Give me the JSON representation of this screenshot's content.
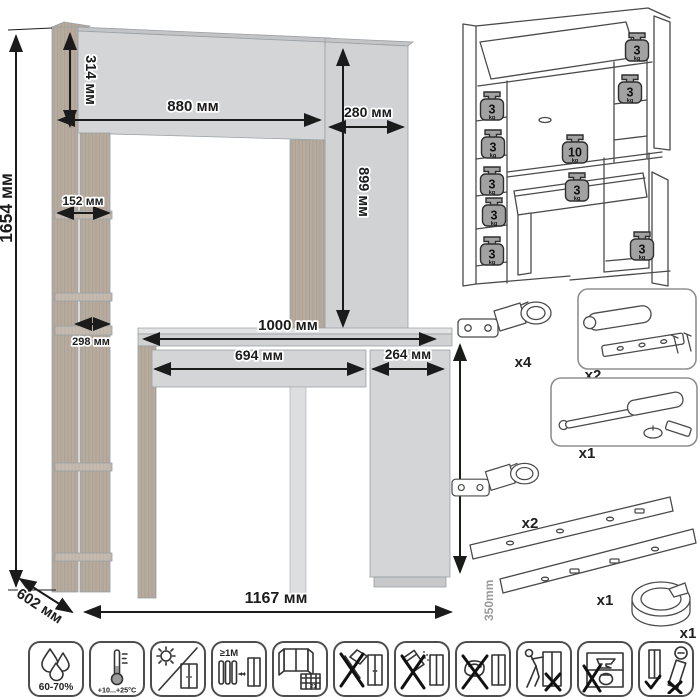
{
  "dimensions": {
    "total_height": "1654 мм",
    "hutch_height": "314 мм",
    "hutch_width": "880 мм",
    "top_right_width": "280 мм",
    "right_column_height": "899 мм",
    "upper_shelf_depth": "152 мм",
    "lower_shelf_depth": "298 мм",
    "desktop_width": "1000 мм",
    "drawer_width": "694 мм",
    "base_door_width": "264 мм",
    "desk_height": "746 мм",
    "depth": "602 мм",
    "total_width": "1167 мм"
  },
  "load_limits": {
    "weights": [
      {
        "value": "3",
        "unit": "kg",
        "location": "hutch-flap-shelf"
      },
      {
        "value": "3",
        "unit": "kg",
        "location": "right-column-shelf"
      },
      {
        "value": "3",
        "unit": "kg",
        "location": "left-shelf-1"
      },
      {
        "value": "3",
        "unit": "kg",
        "location": "left-shelf-2"
      },
      {
        "value": "3",
        "unit": "kg",
        "location": "left-shelf-3"
      },
      {
        "value": "3",
        "unit": "kg",
        "location": "left-shelf-4"
      },
      {
        "value": "3",
        "unit": "kg",
        "location": "left-shelf-5"
      },
      {
        "value": "10",
        "unit": "kg",
        "location": "desktop"
      },
      {
        "value": "3",
        "unit": "kg",
        "location": "drawer"
      },
      {
        "value": "3",
        "unit": "kg",
        "location": "base-cabinet-shelf"
      }
    ]
  },
  "hardware": {
    "items": [
      {
        "name": "concealed-hinge",
        "qty": "x4"
      },
      {
        "name": "flap-damper-kit",
        "qty": "x2"
      },
      {
        "name": "gas-lift",
        "qty": "x1"
      },
      {
        "name": "concealed-hinge",
        "qty": "x2"
      },
      {
        "name": "drawer-slides",
        "qty": "x1",
        "length": "350mm"
      },
      {
        "name": "cable-grommet",
        "qty": "x1"
      }
    ]
  },
  "care": {
    "humidity": "60-70%",
    "temperature": "+10...+25°C",
    "heater_distance": "≥1M",
    "calendar_day": "21"
  }
}
